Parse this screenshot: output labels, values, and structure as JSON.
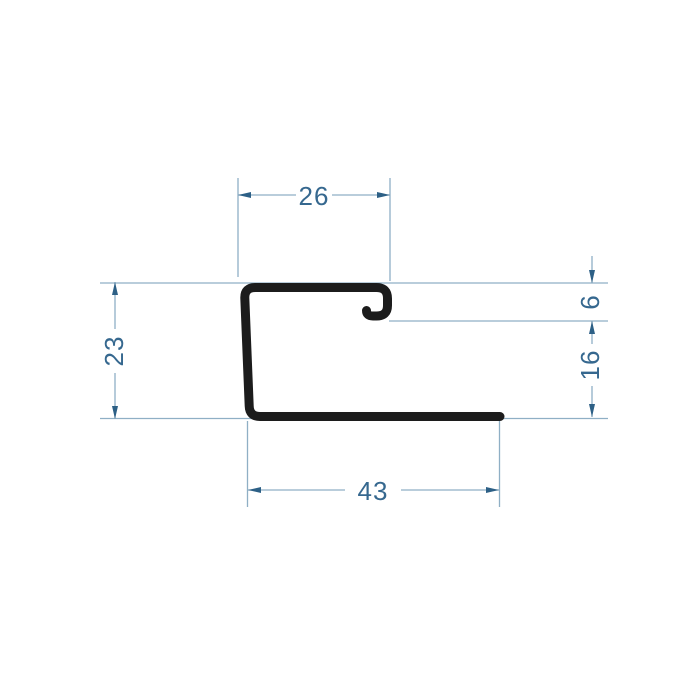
{
  "drawing": {
    "kind": "technical-dimension-drawing",
    "subject": "j-profile-cross-section",
    "colors": {
      "background": "#ffffff",
      "profile": "#1c1c1c",
      "dim_line": "#8fafc5",
      "arrow": "#2d6086",
      "text": "#36688f"
    },
    "dimensions": {
      "top_width": "26",
      "left_height": "23",
      "hook_depth": "6",
      "right_height": "16",
      "bottom_width": "43"
    },
    "profile": {
      "path": "M 500 416.5 L 260 416.5 Q 249.5 416.5 249.2 406 L 244.8 298 Q 244.5 287.5 255.5 287.5 L 376.5 287.5 Q 387.5 287.5 387.5 298.5 L 387.5 305.5 Q 387.5 316 376.5 316 L 373 316 Q 366.5 316 366.5 310.5",
      "stroke_width": 9
    },
    "construction_lines": [
      {
        "x1": 100,
        "y1": 283,
        "x2": 608,
        "y2": 283
      },
      {
        "x1": 389,
        "y1": 321,
        "x2": 608,
        "y2": 321
      },
      {
        "x1": 100,
        "y1": 418.5,
        "x2": 608,
        "y2": 418.5
      }
    ],
    "extension_lines": [
      {
        "x1": 238,
        "y1": 178,
        "x2": 238,
        "y2": 277
      },
      {
        "x1": 390,
        "y1": 178,
        "x2": 390,
        "y2": 281
      },
      {
        "x1": 247.5,
        "y1": 421,
        "x2": 247.5,
        "y2": 507
      },
      {
        "x1": 499.5,
        "y1": 418,
        "x2": 499.5,
        "y2": 507
      }
    ],
    "dimension_segments": [
      {
        "x1": 238,
        "y1": 195,
        "x2": 296,
        "y2": 195
      },
      {
        "x1": 332,
        "y1": 195,
        "x2": 390,
        "y2": 195
      },
      {
        "x1": 115,
        "y1": 282,
        "x2": 115,
        "y2": 329
      },
      {
        "x1": 115,
        "y1": 373,
        "x2": 115,
        "y2": 419
      },
      {
        "x1": 592,
        "y1": 256,
        "x2": 592,
        "y2": 283
      },
      {
        "x1": 592,
        "y1": 321,
        "x2": 592,
        "y2": 344
      },
      {
        "x1": 592,
        "y1": 386,
        "x2": 592,
        "y2": 417
      },
      {
        "x1": 248,
        "y1": 490,
        "x2": 345,
        "y2": 490
      },
      {
        "x1": 401,
        "y1": 490,
        "x2": 499,
        "y2": 490
      }
    ],
    "arrows": [
      {
        "dir": "left",
        "points": "238,195 251,192 251,198"
      },
      {
        "dir": "right",
        "points": "390,195 377,192 377,198"
      },
      {
        "dir": "up",
        "points": "115,282 112,295 118,295"
      },
      {
        "dir": "down",
        "points": "115,419 112,406 118,406"
      },
      {
        "dir": "down",
        "points": "592,283 589,270 595,270"
      },
      {
        "dir": "up",
        "points": "592,321 589,334 595,334"
      },
      {
        "dir": "down",
        "points": "592,417 589,404 595,404"
      },
      {
        "dir": "left",
        "points": "248,490 261,487 261,493"
      },
      {
        "dir": "right",
        "points": "499,490 486,487 486,493"
      }
    ]
  }
}
